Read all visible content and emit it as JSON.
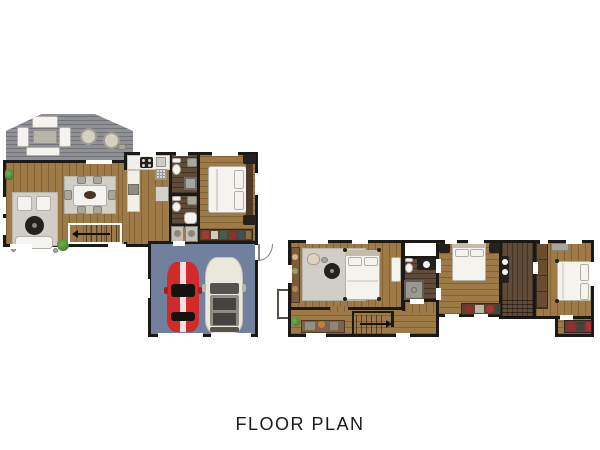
{
  "title": "FLOOR PLAN",
  "colors": {
    "background": "#ffffff",
    "wall": "#1b1916",
    "wood": "#9d7a46",
    "tile": "#5f4b38",
    "deck": "#8f9196",
    "garage_floor": "#71809c",
    "rug": "#d0cec7",
    "white_furniture": "#f4f3ef",
    "counter": "#f1efe9",
    "gray_furniture": "#a9a69c",
    "black_furniture": "#23201d",
    "car_red": "#d12a28",
    "suv_white": "#eae7db",
    "plant": "#4f8a39",
    "plant_dark": "#2f6323",
    "text": "#1a1a1a"
  },
  "floors": [
    {
      "id": "first-floor",
      "rooms": [
        {
          "name": "deck",
          "furniture": [
            "outdoor-sofa",
            "outdoor-chair",
            "outdoor-chair",
            "outdoor-table",
            "outdoor-bench",
            "egg-chair",
            "egg-chair",
            "side-table"
          ]
        },
        {
          "name": "living-room",
          "furniture": [
            "rug",
            "armchair",
            "armchair",
            "round-coffee-table",
            "sofa",
            "plant",
            "shelf-plant"
          ]
        },
        {
          "name": "dining-area",
          "furniture": [
            "rug",
            "dining-table",
            "chair",
            "chair",
            "chair",
            "chair",
            "chair",
            "chair"
          ]
        },
        {
          "name": "kitchen",
          "furniture": [
            "counter",
            "stove",
            "sink",
            "oven",
            "drying-rack",
            "refrigerator"
          ]
        },
        {
          "name": "bathroom",
          "furniture": [
            "toilet",
            "sink",
            "shower"
          ]
        },
        {
          "name": "bathroom",
          "furniture": [
            "toilet",
            "sink",
            "bathtub"
          ]
        },
        {
          "name": "laundry",
          "furniture": [
            "washer",
            "dryer"
          ]
        },
        {
          "name": "bedroom",
          "furniture": [
            "double-bed",
            "nightstand",
            "nightstand",
            "dresser"
          ]
        },
        {
          "name": "stairs",
          "furniture": [
            "direction-arrow"
          ]
        },
        {
          "name": "garage",
          "furniture": [
            "red-sports-car",
            "white-suv",
            "entry-door"
          ]
        }
      ]
    },
    {
      "id": "second-floor",
      "rooms": [
        {
          "name": "master-bedroom",
          "furniture": [
            "rug",
            "double-bed",
            "armchair",
            "ottoman",
            "round-table",
            "console",
            "wardrobe"
          ]
        },
        {
          "name": "closet",
          "furniture": []
        },
        {
          "name": "bathroom",
          "furniture": [
            "vanity-sink",
            "toilet",
            "shower"
          ]
        },
        {
          "name": "bedroom",
          "furniture": [
            "double-bed",
            "nightstand",
            "nightstand",
            "dresser"
          ]
        },
        {
          "name": "bathroom",
          "furniture": [
            "sink",
            "sink",
            "stairwell"
          ]
        },
        {
          "name": "bedroom",
          "furniture": [
            "double-bed",
            "closet",
            "bench",
            "dresser"
          ]
        },
        {
          "name": "hallway",
          "furniture": [
            "desk",
            "plant",
            "stairs",
            "dresser"
          ]
        }
      ]
    }
  ]
}
